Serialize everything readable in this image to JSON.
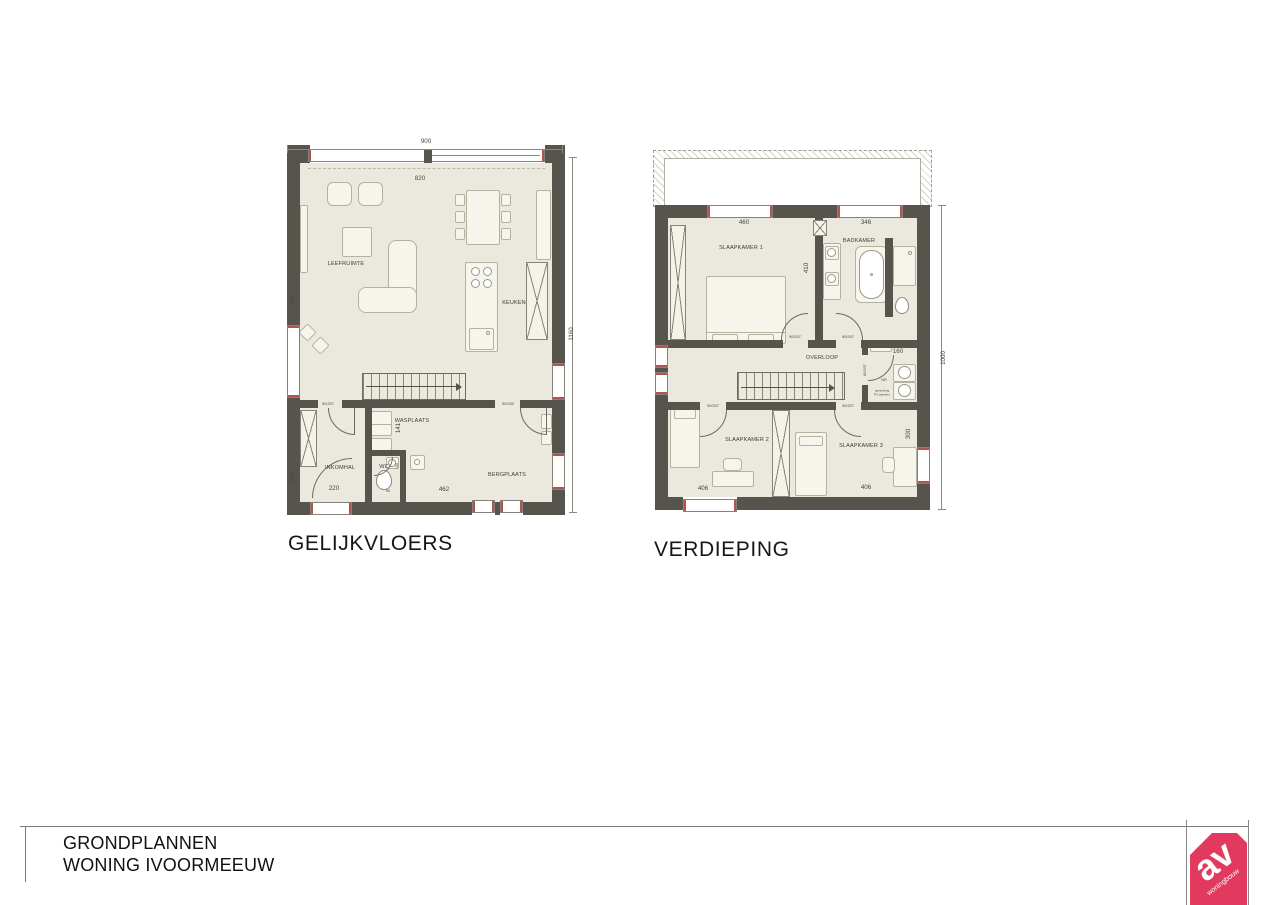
{
  "ground_floor": {
    "title": "GELIJKVLOERS",
    "rooms": {
      "leefruimte": "LEEFRUIMTE",
      "keuken": "KEUKEN",
      "wasplaats": "WASPLAATS",
      "inkomhal": "INKOMHAL",
      "wc": "WC",
      "bergplaats": "BERGPLAATS"
    },
    "dims": {
      "total_width": "900",
      "top_window": "820",
      "left_height": "766",
      "right_height": "1160",
      "inkomhal_height": "314",
      "inkomhal_width": "220",
      "bottom_width": "462",
      "wasplaats_depth": "141",
      "wc_depth": "100",
      "wc_width": "90",
      "door_inkomhal": "90/207",
      "door_wc": "90/207",
      "door_bergplaats": "90/230"
    }
  },
  "upper_floor": {
    "title": "VERDIEPING",
    "rooms": {
      "slaapkamer1": "SLAAPKAMER 1",
      "badkamer": "BADKAMER",
      "overloop": "OVERLOOP",
      "slaapkamer2": "SLAAPKAMER 2",
      "slaapkamer3": "SLAAPKAMER 3"
    },
    "dims": {
      "slaapkamer1_width": "460",
      "badkamer_width": "346",
      "partition_depth": "410",
      "berging_width": "160",
      "right_depth": "300",
      "slaapkamer2_width": "406",
      "slaapkamer3_width": "406",
      "total_height": "1000",
      "door_slaapkamer1": "90/207",
      "door_badkamer": "90/207",
      "door_slaapkamer2": "90/207",
      "door_slaapkamer3": "90/207",
      "door_berging": "60/207"
    },
    "notes": {
      "berging_label": "NR",
      "pv_line1": "aansluiting",
      "pv_line2": "PV panelen"
    }
  },
  "title_block": {
    "line1": "GRONDPLANNEN",
    "line2": "WONING IVOORMEEUW"
  },
  "logo": {
    "text": "av",
    "subtext": "woningbouw"
  }
}
